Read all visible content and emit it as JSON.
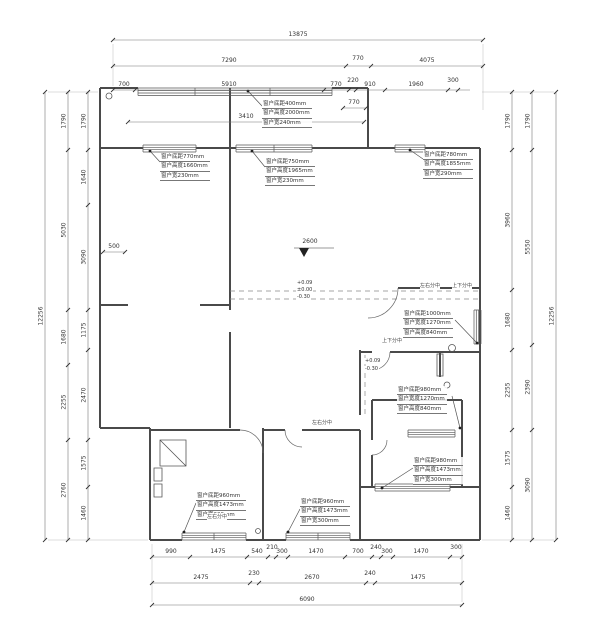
{
  "floor_plan": {
    "window_callouts": [
      {
        "lines": [
          "窗户底距400mm",
          "窗户高度2000mm",
          "窗户宽240mm"
        ]
      },
      {
        "lines": [
          "窗户底距770mm",
          "窗户高度1660mm",
          "窗户宽230mm"
        ]
      },
      {
        "lines": [
          "窗户底距750mm",
          "窗户高度1965mm",
          "窗户宽230mm"
        ]
      },
      {
        "lines": [
          "窗户底距780mm",
          "窗户高度1855mm",
          "窗户宽290mm"
        ]
      },
      {
        "lines": [
          "窗户底距1000mm",
          "窗户宽度1270mm",
          "窗户高度840mm"
        ]
      },
      {
        "lines": [
          "窗户底距980mm",
          "窗户宽度1270mm",
          "窗户高度840mm"
        ]
      },
      {
        "lines": [
          "窗户底距980mm",
          "窗户高度1473mm",
          "窗户宽300mm"
        ]
      },
      {
        "lines": [
          "窗户底距960mm",
          "窗户高度1473mm",
          "窗户宽300mm"
        ]
      },
      {
        "lines": [
          "窗户底距960mm",
          "窗户高度1473mm",
          "窗户宽300mm"
        ]
      }
    ],
    "level_marker": {
      "value": "2600"
    },
    "floor_levels": [
      "+0.09",
      "±0.00",
      "-0.30"
    ],
    "corridor_levels": [
      "+0.09",
      "-0.30"
    ],
    "inline_dims": {
      "balcony": "3410",
      "step": "770",
      "closet": "500"
    },
    "notes": [
      "左右分中",
      "上下分中",
      "上下分中",
      "左右分中",
      "左右分中"
    ],
    "dimensions": {
      "top": [
        [
          "13875"
        ],
        [
          "7290",
          "770",
          "4075"
        ],
        [
          "700",
          "5910",
          "770",
          "220",
          "910",
          "1960",
          "300"
        ]
      ],
      "bottom": [
        [
          "990",
          "1475",
          "540",
          "210",
          "300",
          "1470",
          "700",
          "240",
          "300",
          "1470",
          "300"
        ],
        [
          "2475",
          "230",
          "2670",
          "240",
          "1475"
        ],
        [
          "6090"
        ]
      ],
      "left": [
        [
          "12256"
        ],
        [
          "1790",
          "5030",
          "1680",
          "2255",
          "2760"
        ],
        [
          "1790",
          "1640",
          "3090",
          "1175",
          "2470",
          "1575",
          "1460"
        ]
      ],
      "right": [
        [
          "1790",
          "3960",
          "1680",
          "2255",
          "1575",
          "1460"
        ],
        [
          "1790",
          "5550",
          "2390",
          "3090"
        ],
        [
          "12256"
        ]
      ]
    }
  }
}
